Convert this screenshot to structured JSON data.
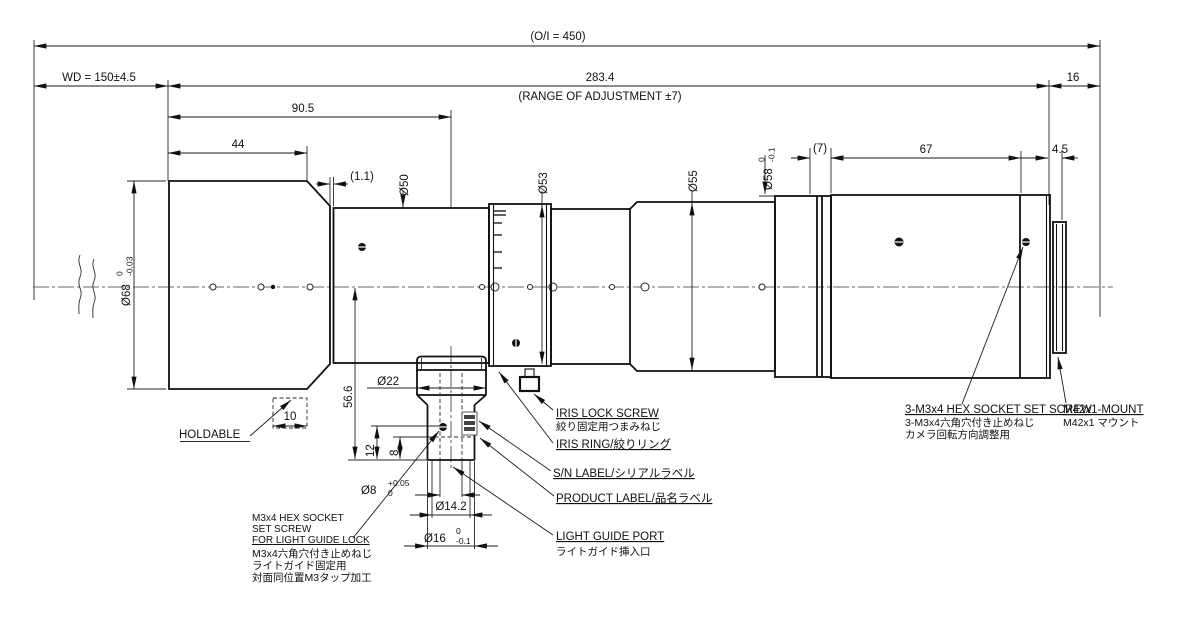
{
  "colors": {
    "line": "#1a1a1a",
    "background": "#ffffff"
  },
  "dims": {
    "oi": "(O/I = 450)",
    "wd": "WD = 150±4.5",
    "total": "283.4",
    "range": "(RANGE OF ADJUSTMENT ±7)",
    "d16": "16",
    "d90_5": "90.5",
    "d44": "44",
    "d1_1": "(1.1)",
    "d50": "Ø50",
    "d53": "Ø53",
    "d55": "Ø55",
    "d58": "Ø58",
    "d58_tol_u": "0",
    "d58_tol_l": "-0.1",
    "d7": "(7)",
    "d67": "67",
    "d4_5": "4.5",
    "d68": "Ø68",
    "d68_tol_u": "0",
    "d68_tol_l": "-0.03",
    "d10": "10",
    "d56_6": "56.6",
    "d22": "Ø22",
    "d12": "12",
    "d8v": "8",
    "d8": "Ø8",
    "d8_tol_u": "+0.05",
    "d8_tol_l": "0",
    "d14_2": "Ø14.2",
    "d16d": "Ø16",
    "d16d_tol_u": "0",
    "d16d_tol_l": "-0.1"
  },
  "labels": {
    "holdable": "HOLDABLE",
    "iris_lock_en": "IRIS LOCK SCREW",
    "iris_lock_jp": "絞り固定用つまみねじ",
    "iris_ring": "IRIS RING/絞りリング",
    "sn_label": "S/N LABEL/シリアルラベル",
    "product_label": "PRODUCT LABEL/品名ラベル",
    "light_guide_en": "LIGHT GUIDE PORT",
    "light_guide_jp": "ライトガイド挿入口",
    "lg_screw_1": "M3x4 HEX SOCKET",
    "lg_screw_2": "SET SCREW",
    "lg_screw_3": "FOR LIGHT GUIDE LOCK",
    "lg_screw_4": "M3x4六角穴付き止めねじ",
    "lg_screw_5": "ライトガイド固定用",
    "lg_screw_6": "対面同位置M3タップ加工",
    "mount_screw_1": "3-M3x4 HEX SOCKET SET SCREW",
    "mount_screw_2": "3-M3x4六角穴付き止めねじ",
    "mount_screw_3": "カメラ回転方向調整用",
    "mount_en": "M42x1-MOUNT",
    "mount_jp": "M42x1 マウント"
  }
}
